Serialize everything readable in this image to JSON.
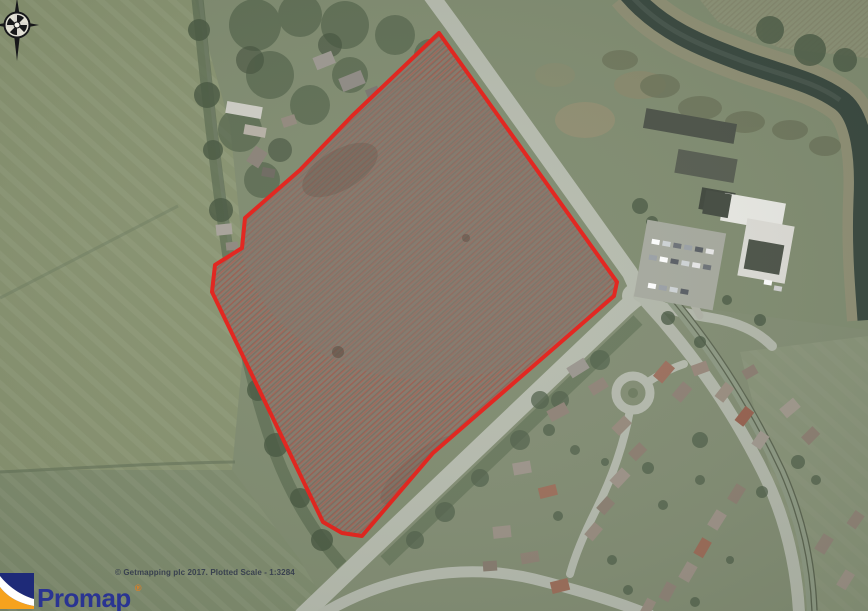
{
  "map": {
    "description": "Aerial photograph site plan with red boundary outline",
    "site_boundary": {
      "points": "439,33 617,282 614,296 433,453 362,536 342,533 323,522 212,292 215,265 242,248 245,218 300,170 352,116",
      "color": "#e41f18",
      "hatch_color": "#c8463a"
    }
  },
  "compass": {
    "icon": "compass-rose"
  },
  "attribution": {
    "text": "© Getmapping plc 2017. Plotted Scale -  1:3284",
    "provider": "© Getmapping plc 2017.",
    "plotted_scale": "1:3284"
  },
  "logo": {
    "name": "Promap",
    "registered": "®",
    "brand_blue": "#2a3492",
    "brand_orange": "#f6a21d"
  }
}
